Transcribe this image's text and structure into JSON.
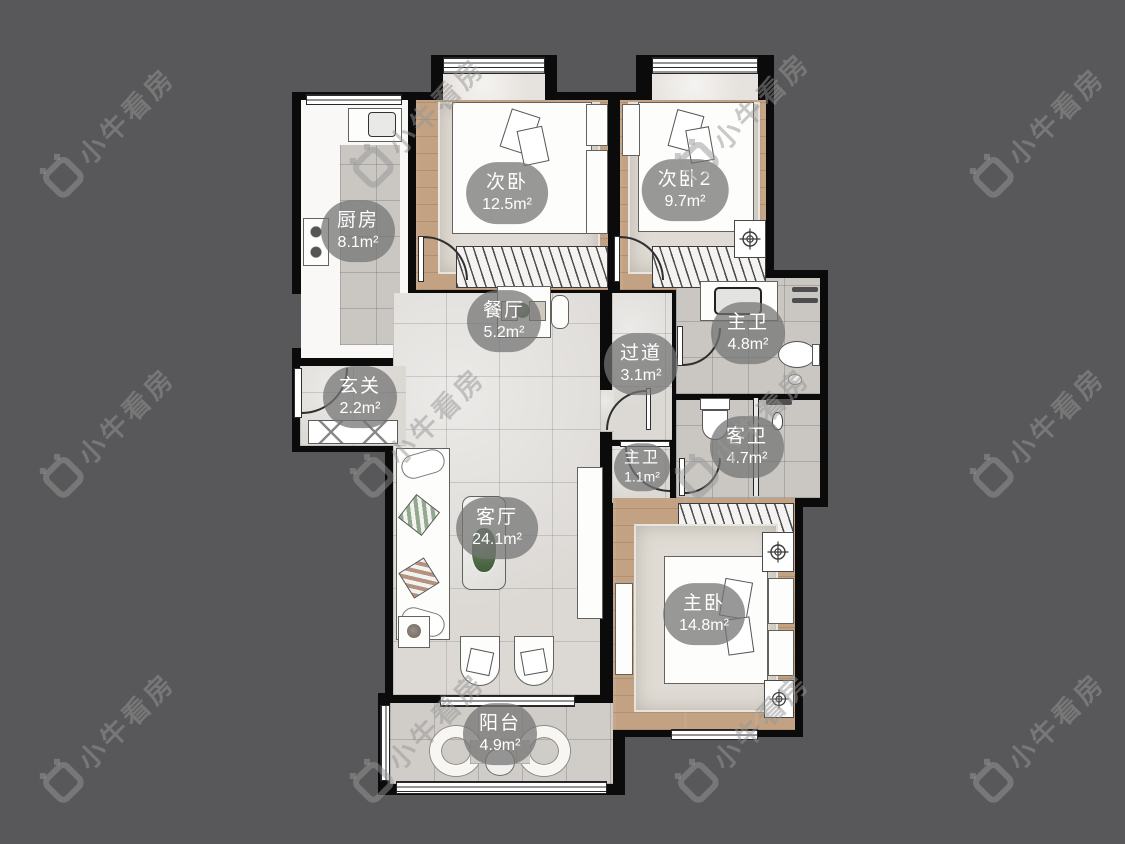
{
  "watermark": {
    "brand": "小牛看房"
  },
  "colors": {
    "background": "#58585a",
    "wall": "#0b0b0b",
    "wood_floor": "#c2a283",
    "marble_floor": "#dcd9d5",
    "bath_tile": "#cac7c3",
    "label_pill": "rgba(116,116,116,0.74)",
    "label_text": "#ffffff"
  },
  "rooms": {
    "kitchen": {
      "name": "厨房",
      "area": "8.1m²"
    },
    "bedroom_a": {
      "name": "次卧",
      "area": "12.5m²"
    },
    "bedroom_b": {
      "name": "次卧2",
      "area": "9.7m²"
    },
    "master_bath": {
      "name": "主卫",
      "area": "4.8m²"
    },
    "guest_bath": {
      "name": "客卫",
      "area": "4.7m²"
    },
    "corridor": {
      "name": "过道",
      "area": "3.1m²"
    },
    "dining": {
      "name": "餐厅",
      "area": "5.2m²"
    },
    "foyer": {
      "name": "玄关",
      "area": "2.2m²"
    },
    "master_bath_lobby": {
      "name": "主卫",
      "area": "1.1m²"
    },
    "living": {
      "name": "客厅",
      "area": "24.1m²"
    },
    "master_bedroom": {
      "name": "主卧",
      "area": "14.8m²"
    },
    "balcony": {
      "name": "阳台",
      "area": "4.9m²"
    }
  }
}
